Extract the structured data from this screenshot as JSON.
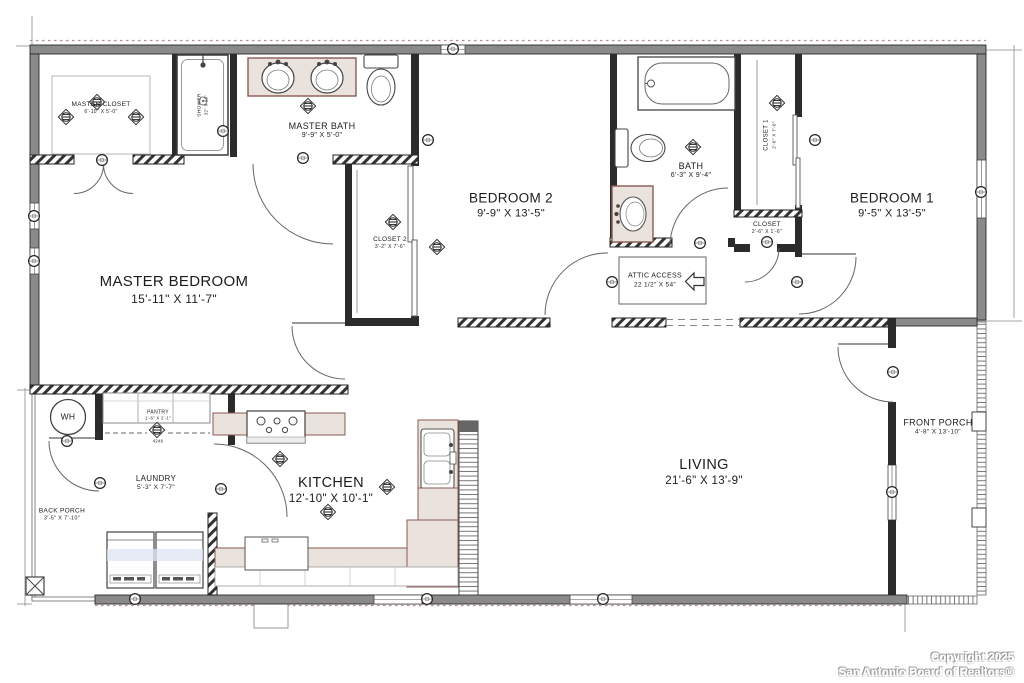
{
  "plan": {
    "rooms": {
      "master_closet": {
        "name": "MASTER CLOSET",
        "dims": "6'-10\" X 5'-0\""
      },
      "master_bath": {
        "name": "MASTER BATH",
        "dims": "9'-9\" X 5'-0\""
      },
      "shower": {
        "name": "SHOWER",
        "dims": "32\" X 60\""
      },
      "master_bedroom": {
        "name": "MASTER BEDROOM",
        "dims": "15'-11\" X 11'-7\""
      },
      "closet_2": {
        "name": "CLOSET 2",
        "dims": "3'-2\" X 7'-6\""
      },
      "bedroom_2": {
        "name": "BEDROOM 2",
        "dims": "9'-9\" X 13'-5\""
      },
      "bath": {
        "name": "BATH",
        "dims": "6'-3\" X 9'-4\""
      },
      "closet_1": {
        "name": "CLOSET 1",
        "dims": "2'-6\" X 7'-6\""
      },
      "bedroom_1": {
        "name": "BEDROOM 1",
        "dims": "9'-5\" X 13'-5\""
      },
      "closet": {
        "name": "CLOSET",
        "dims": "2'-6\" X 1'-6\""
      },
      "attic_access": {
        "name": "ATTIC ACCESS",
        "dims": "22 1/2\" X 54\""
      },
      "water_heater": {
        "name": "WH"
      },
      "pantry": {
        "name": "PANTRY",
        "dims": "1'-6\" X 2'-1\"",
        "note": "4248"
      },
      "laundry": {
        "name": "LAUNDRY",
        "dims": "5'-3\" X 7'-7\""
      },
      "kitchen": {
        "name": "KITCHEN",
        "dims": "12'-10\" X 10'-1\""
      },
      "living": {
        "name": "LIVING",
        "dims": "21'-6\" X 13'-9\""
      },
      "front_porch": {
        "name": "FRONT PORCH",
        "dims": "4'-8\" X 13'-10\""
      },
      "back_porch": {
        "name": "BACK PORCH",
        "dims": "3'-5\" X 7'-10\""
      }
    },
    "fixtures": [
      "bathtub",
      "shower",
      "double-vanity-sinks",
      "toilet",
      "vanity-sink",
      "kitchen-sink",
      "range-cooktop",
      "washer",
      "dryer",
      "water-heater",
      "pantry-shelves",
      "attic-access-arrow"
    ],
    "colors": {
      "wall_fill": "#8a8a8a",
      "wall_dark": "#2b2b2b",
      "counter": "#e9e2dd",
      "counter_edge": "#8b5a52",
      "appliance_tint": "#dfe4f2",
      "roofline_dash": "#b08f9f"
    }
  },
  "footer": {
    "line1": "Copyright 2025",
    "line2": "San Antonio Board of Realtors®"
  }
}
